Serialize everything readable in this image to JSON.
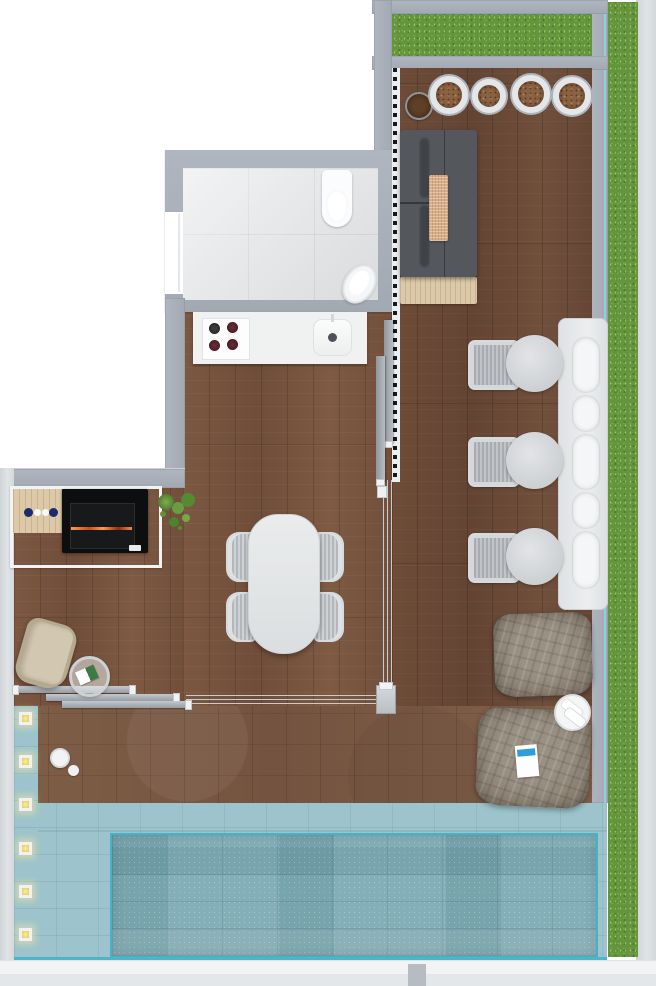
{
  "meta": {
    "type": "floor-plan-rendering",
    "view": "top-down",
    "text_visible": "none"
  },
  "palette": {
    "background": "#ffffff",
    "wall": "#a6adb6",
    "outer_edge": "#d9dde0",
    "indoor_wood": "#7a5641",
    "terrace_wood": "#6b4a36",
    "deck_wood": "#7d5c45",
    "bath_tile": "#e6e7e9",
    "counter": "#f0f1f1",
    "grass": "#63953f",
    "pool_ledge": "#9dc4cc",
    "pool_basin": "#84afb9",
    "pool_accent": "#45b2c8",
    "glass_balustrade": "#8ed4e2",
    "sofa": "#54575c",
    "console_wood": "#dbc9a9",
    "grill": "#0d0e0f",
    "ember": "#ff8a3c",
    "beanbag": "#8c8274",
    "planter_rim": "#e4e7e9",
    "planter_soil": "#8a6141",
    "recliner": "#d2c7b0",
    "navy_plate": "#1c2a6e",
    "magazine_stripe": "#2e9fd6"
  },
  "rooms": [
    {
      "name": "bathroom",
      "features": [
        "toilet",
        "washbasin",
        "tiled-floor",
        "door-opening"
      ]
    },
    {
      "name": "kitchen",
      "features": [
        "counter",
        "cooktop-4-burners",
        "sink-with-faucet"
      ]
    },
    {
      "name": "living-dining",
      "features": [
        "dining-table",
        "4-dining-chairs",
        "sofa",
        "2-sofa-pillows",
        "patterned-throw",
        "wood-console"
      ]
    },
    {
      "name": "bbq-corner",
      "features": [
        "black-grill-with-embers",
        "wood-side-table",
        "2-navy-plates",
        "2-white-plates",
        "green-plant",
        "white-frame"
      ]
    },
    {
      "name": "terrace-lounge",
      "features": [
        "3-woven-lounge-chairs",
        "3-round-side-tables",
        "built-in-bench",
        "5-bench-cushions",
        "4-round-planters",
        "small-dark-pot",
        "2-bean-bags",
        "towel-side-table",
        "magazine",
        "beige-recliner",
        "glass-side-table"
      ]
    },
    {
      "name": "pool-deck",
      "features": [
        "swimming-pool",
        "pool-ledge",
        "6-underwater-lights",
        "wood-deck",
        "white-vase",
        "white-pebble"
      ]
    },
    {
      "name": "openings",
      "features": [
        "corner-sliding-glass-doors",
        "2-vertical-parked-panels",
        "3-horizontal-parked-panels",
        "corner-post",
        "shutter-track-strip"
      ]
    },
    {
      "name": "garden",
      "features": [
        "top-grass-strip",
        "right-grass-strip",
        "glass-balustrade-line"
      ]
    }
  ],
  "counts": {
    "planters": 4,
    "bench_cushions": 5,
    "patio_chairs": 3,
    "patio_tables": 3,
    "dining_chairs": 4,
    "pool_lights": 6,
    "bean_bags": 2,
    "sliding_panels_vertical": 2,
    "sliding_panels_horizontal": 3,
    "cooktop_burners": 4
  }
}
